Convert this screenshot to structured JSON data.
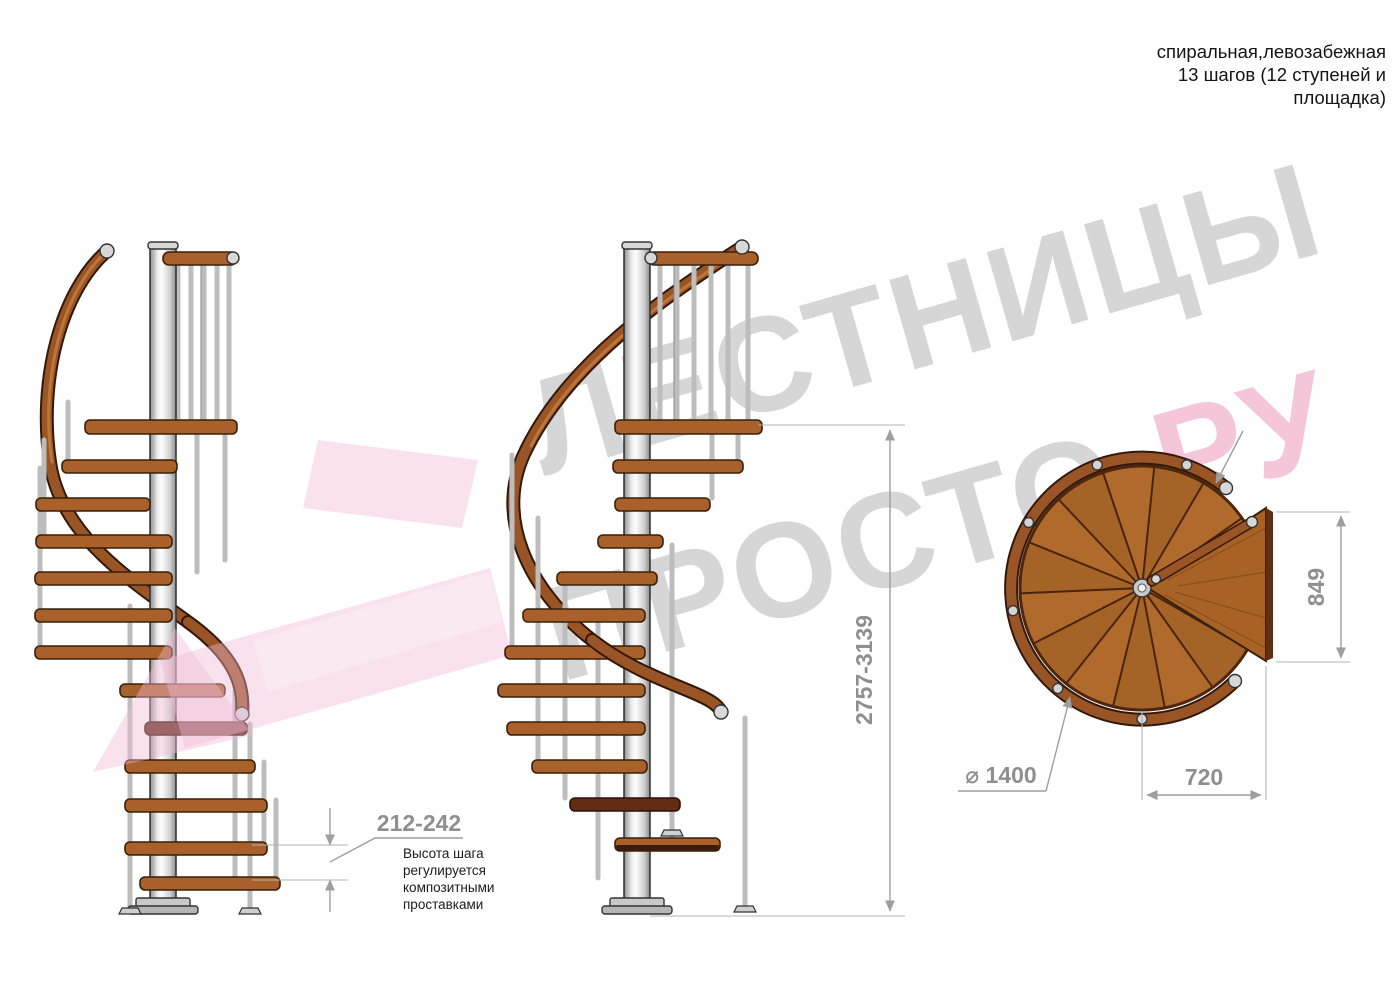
{
  "header": {
    "lines": [
      "спиральная,левозабежная",
      "13 шагов (12 ступеней и",
      "площадка)"
    ]
  },
  "watermark": {
    "word1": "ЛЕСТНИЦЫ",
    "word2": "ПРОСТО",
    "word3": ".РУ",
    "gray_color": "#a7a7a7",
    "pink_color": "#ef9cc0",
    "arrow_color": "#f3c6de"
  },
  "dimensions": {
    "step_height": {
      "value": "212-242",
      "note": [
        "Высота шага",
        "регулируется",
        "композитными",
        "проставками"
      ]
    },
    "total_height": "2757-3139",
    "landing_side": "849",
    "landing_width": "720",
    "diameter": "⌀ 1400"
  },
  "drawing_colors": {
    "wood": "#a9602a",
    "wood_dark": "#632c15",
    "handrail": "#9a5526",
    "metal": "#d8d8d8",
    "dimension_lines": "#9e9e9e",
    "dimension_text": "#8f8f8f",
    "note_text": "#1b1b1b"
  }
}
